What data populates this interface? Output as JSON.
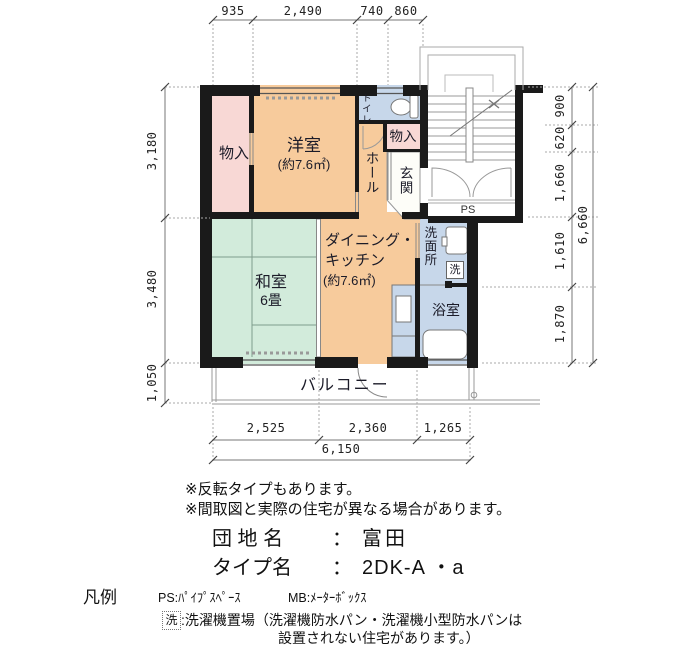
{
  "plan": {
    "rooms": {
      "closet_left": {
        "label": "物入"
      },
      "western_room": {
        "label": "洋室",
        "area": "(約7.6㎡)"
      },
      "toilet": {
        "label": "トイレ"
      },
      "closet_right": {
        "label": "物入"
      },
      "hall": {
        "label": "ホール"
      },
      "entrance": {
        "label": "玄関"
      },
      "pipe_space": {
        "label": "PS"
      },
      "dining_kitchen": {
        "label1": "ダイニング・",
        "label2": "キッチン",
        "area": "(約7.6㎡)"
      },
      "washroom": {
        "label": "洗面所"
      },
      "laundry": {
        "label": "洗"
      },
      "bathroom": {
        "label": "浴室"
      },
      "japanese_room": {
        "label": "和室",
        "size": "6畳"
      },
      "balcony": {
        "label": "バルコニー"
      }
    },
    "dimensions": {
      "top": [
        "935",
        "2,490",
        "740",
        "860"
      ],
      "left": [
        "3,180",
        "3,480",
        "1,050"
      ],
      "right": [
        "900",
        "620",
        "1,660",
        "1,610",
        "1,870"
      ],
      "right_total": "6,660",
      "bottom": [
        "2,525",
        "2,360",
        "1,265"
      ],
      "bottom_total": "6,150"
    }
  },
  "notes": {
    "note1": "※反転タイプもあります。",
    "note2": "※間取図と実際の住宅が異なる場合があります。"
  },
  "info": {
    "estate_label": "団 地 名",
    "type_label": "タイプ名",
    "separator": "：",
    "estate_value": "富田",
    "type_value": "2DK-A ・a"
  },
  "legend": {
    "title": "凡例",
    "ps": "PS:ﾊﾟｲﾌﾟｽﾍﾟｰｽ",
    "mb": "MB:ﾒｰﾀｰﾎﾞｯｸｽ",
    "laundry_mark": "洗",
    "laundry_text": ":洗濯機置場（洗濯機防水パン・洗濯機小型防水パンは",
    "laundry_text2": "設置されない住宅があります。）"
  },
  "colors": {
    "closet_pink": "#f8d8d5",
    "room_orange": "#f7cb9c",
    "wet_area_blue": "#c7d7ea",
    "tatami_green": "#d2ebdb",
    "wall_black": "#1a1a1a"
  }
}
